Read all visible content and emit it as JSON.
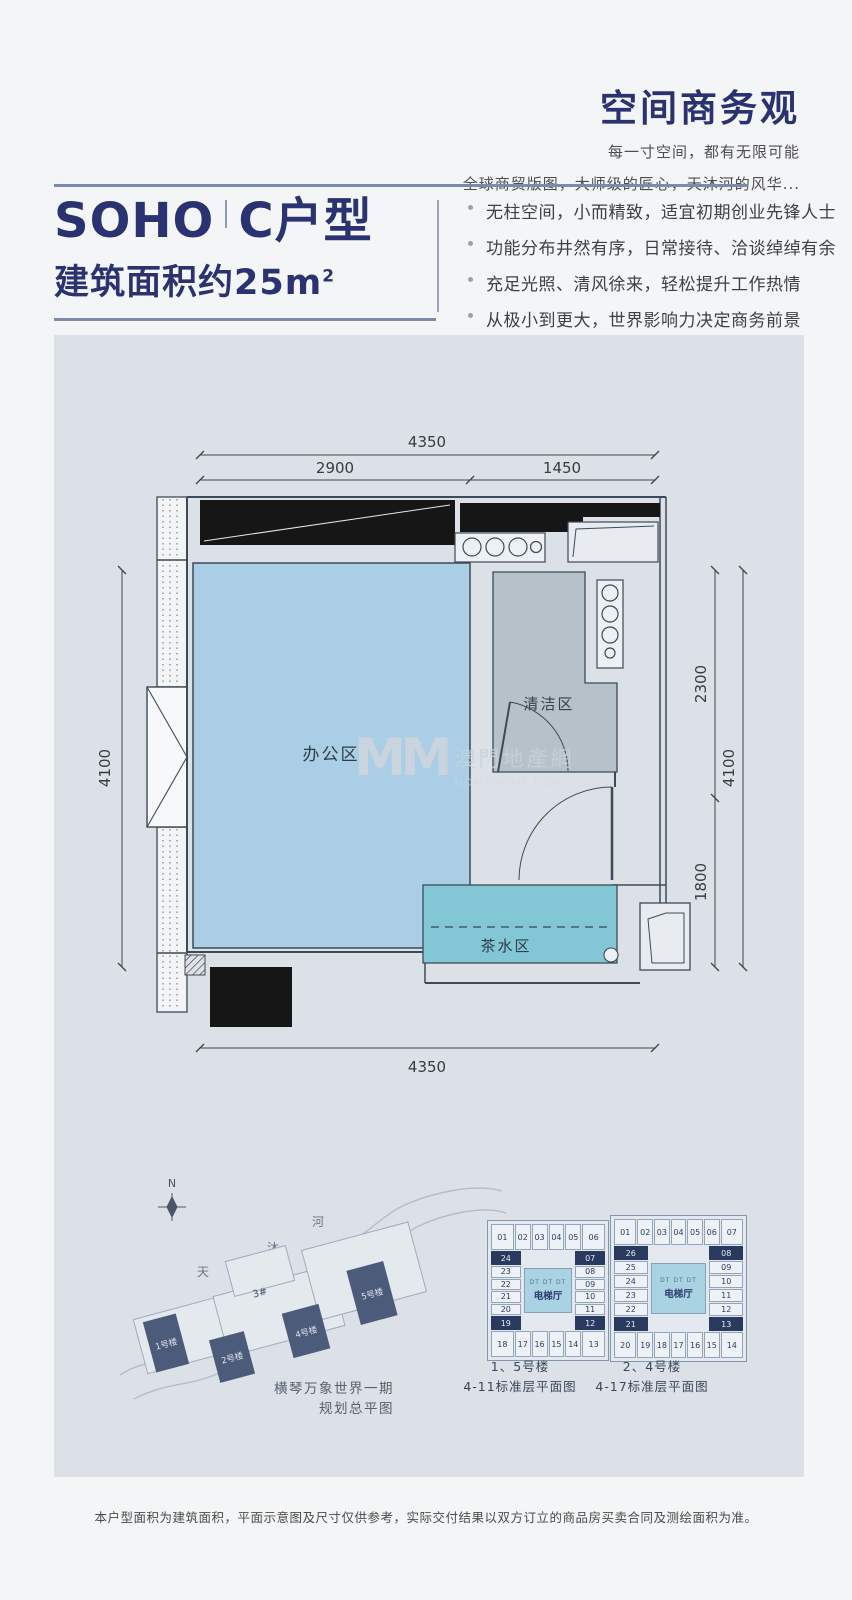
{
  "header": {
    "title": "空间商务观",
    "subtitle1": "每一寸空间，都有无限可能",
    "subtitle2": "全球商贸版图，大师级的匠心，天沐河的风华..."
  },
  "unit": {
    "name_en": "SOHO",
    "name_cn": "C户型",
    "area_label": "建筑面积约25m",
    "area_sup": "2"
  },
  "features": [
    "无柱空间，小而精致，适宜初期创业先锋人士",
    "功能分布井然有序，日常接待、洽谈绰绰有余",
    "充足光照、清风徐来，轻松提升工作热情",
    "从极小到更大，世界影响力决定商务前景"
  ],
  "plan": {
    "rooms": {
      "office": "办公区",
      "clean": "清洁区",
      "tea": "茶水区"
    },
    "dims": {
      "top_total": "4350",
      "top_left": "2900",
      "top_right": "1450",
      "left": "4100",
      "right_upper": "2300",
      "right_lower": "1800",
      "right_total": "4100",
      "bottom_total": "4350"
    }
  },
  "watermark": {
    "logo": "MM",
    "name": "澳門地產網",
    "domain": "HOMEHOME.COM"
  },
  "siteplan": {
    "compass": "N",
    "river": [
      "天",
      "沐",
      "河"
    ],
    "buildings": [
      "1号楼",
      "2号楼",
      "3#",
      "4号楼",
      "5号楼"
    ],
    "caption1": "横琴万象世界一期",
    "caption2": "规划总平图"
  },
  "plates": [
    {
      "caption1": "1、5号楼",
      "caption2": "4-11标准层平面图",
      "top": [
        "01",
        "02",
        "03",
        "04",
        "05",
        "06"
      ],
      "upper": [
        "24",
        "07"
      ],
      "left": [
        "23",
        "22",
        "21",
        "20"
      ],
      "right": [
        "08",
        "09",
        "10",
        "11"
      ],
      "lower": [
        "19",
        "12"
      ],
      "bottom": [
        "18",
        "17",
        "16",
        "15",
        "14",
        "13"
      ],
      "center_small": "DT DT DT",
      "center": "电梯厅"
    },
    {
      "caption1": "2、4号楼",
      "caption2": "4-17标准层平面图",
      "top": [
        "01",
        "02",
        "03",
        "04",
        "05",
        "06",
        "07"
      ],
      "upper": [
        "26",
        "08"
      ],
      "left": [
        "25",
        "24",
        "23",
        "22"
      ],
      "right": [
        "09",
        "10",
        "11",
        "12"
      ],
      "lower": [
        "21",
        "13"
      ],
      "bottom": [
        "20",
        "19",
        "18",
        "17",
        "16",
        "15",
        "14"
      ],
      "center_small": "DT DT DT",
      "center": "电梯厅"
    }
  ],
  "disclaimer": "本户型面积为建筑面积，平面示意图及尺寸仅供参考，实际交付结果以双方订立的商品房买卖合同及测绘面积为准。",
  "colors": {
    "navy": "#2b3272",
    "rule": "#7b8cab",
    "panel": "#dce1e8",
    "office_fill": "#a9cee5",
    "clean_fill": "#b6c1c9",
    "tea_fill": "#83c6d6",
    "wall_black": "#161616",
    "line": "#3d4a57",
    "tower": "#4d5b7b",
    "highlight_cell": "#2a3a5f"
  }
}
